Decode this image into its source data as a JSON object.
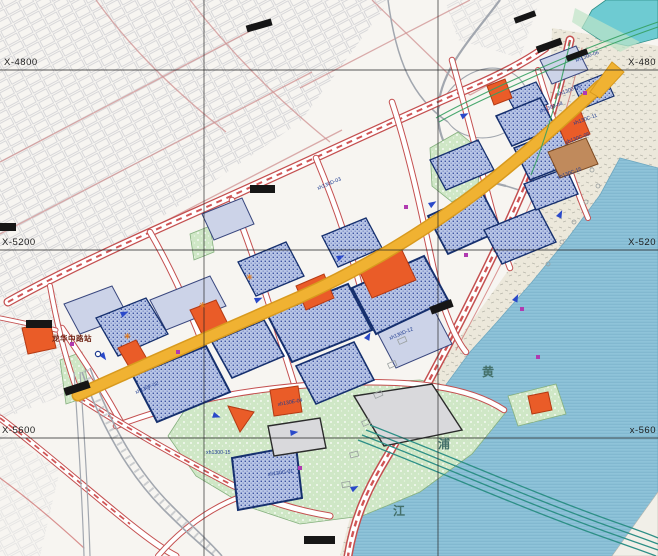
{
  "map": {
    "title": "urban-waterfront-regulatory-plan",
    "grid": {
      "left_labels": [
        {
          "text": "X-4800"
        },
        {
          "text": "X-5200"
        },
        {
          "text": "X-5600"
        }
      ],
      "right_labels": [
        {
          "text": "X-480"
        },
        {
          "text": "X-520"
        },
        {
          "text": "x-560"
        }
      ]
    },
    "river": {
      "name_chars": [
        {
          "ch": "黄"
        },
        {
          "ch": "浦"
        },
        {
          "ch": "江"
        }
      ]
    },
    "station": {
      "label": "龙华中路站"
    },
    "parcel_codes": [
      {
        "text": "xh1300-06"
      },
      {
        "text": "xh1300-05"
      },
      {
        "text": "xh1300-04"
      },
      {
        "text": "xh130C-11"
      },
      {
        "text": "xh130C-05"
      },
      {
        "text": "xh130C-15"
      },
      {
        "text": "xh130D-03"
      },
      {
        "text": "xh130D-12"
      },
      {
        "text": "xh130E-04"
      },
      {
        "text": "xh130F-02"
      },
      {
        "text": "xh1300-15"
      },
      {
        "text": "xh130G-01"
      }
    ],
    "symbols": {
      "flower_marker": "✳"
    },
    "colors": {
      "bg": "#f7f5f1",
      "water": "#8fc3d9",
      "parcelBlue": "#b9c6e6",
      "parcelBlueBorder": "#16306e",
      "lavender": "#ccd3e8",
      "orange": "#ea5c28",
      "green": "#cfe7c6",
      "yellowRoad": "#f0b232",
      "roadRed": "#c45050",
      "labelNavy": "#1d3a8f",
      "teal": "#2d8f86",
      "channel": "#6ecbd2"
    }
  }
}
